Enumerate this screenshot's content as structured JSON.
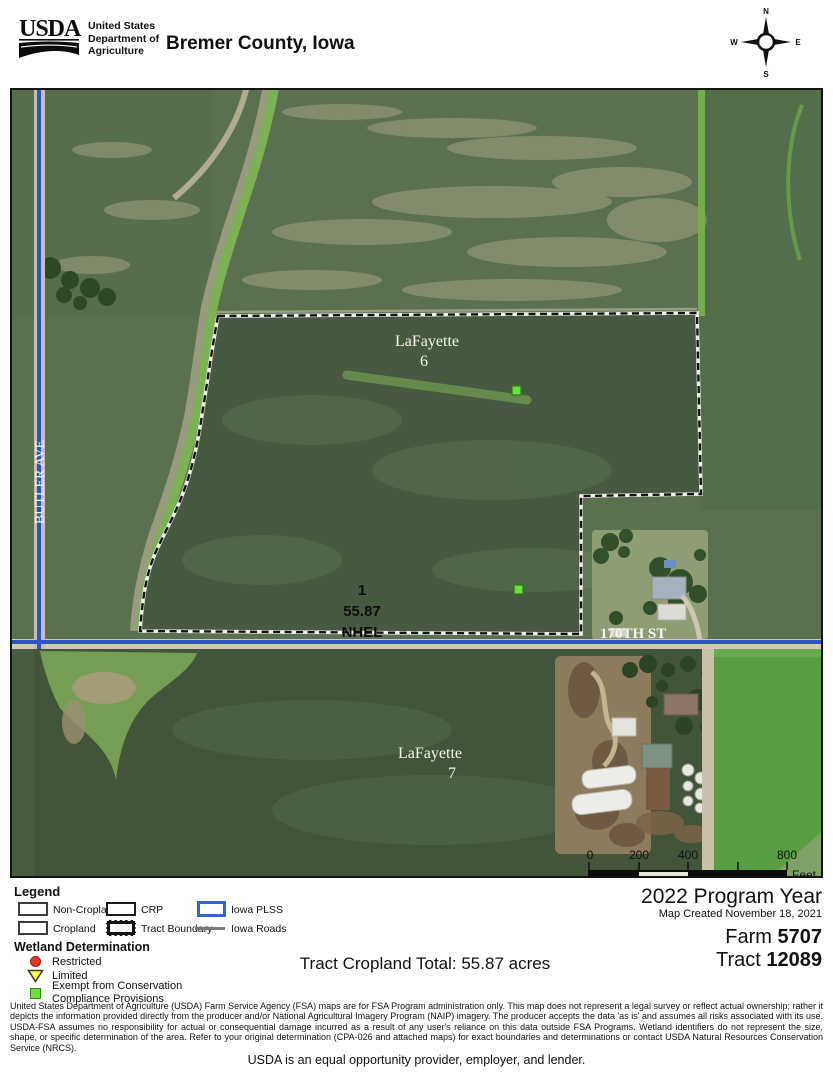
{
  "header": {
    "logo": "USDA",
    "agency_lines": [
      "United States",
      "Department of",
      "Agriculture"
    ],
    "title": "Bremer County, Iowa",
    "compass": {
      "n": "N",
      "e": "E",
      "s": "S",
      "w": "W"
    }
  },
  "map": {
    "sections": {
      "top": {
        "name": "LaFayette",
        "number": "6"
      },
      "bottom": {
        "name": "LaFayette",
        "number": "7"
      }
    },
    "tract_label": {
      "field_number": "1",
      "acres": "55.87",
      "hel": "NHEL"
    },
    "roads": {
      "vertical": "BUTLER AVE",
      "horizontal": "170TH ST"
    },
    "scale_bar": {
      "ticks": [
        "0",
        "200",
        "400",
        "800"
      ],
      "unit": "Feet"
    }
  },
  "legend": {
    "title": "Legend",
    "items": [
      {
        "label": "Non-Cropland",
        "swatch": "outline-gray-box"
      },
      {
        "label": "CRP",
        "swatch": "outline-dark-box"
      },
      {
        "label": "Iowa PLSS",
        "swatch": "outline-blue-box"
      },
      {
        "label": "Cropland",
        "swatch": "outline-dark-box"
      },
      {
        "label": "Tract Boundary",
        "swatch": "thick-dashed-box"
      },
      {
        "label": "Iowa Roads",
        "swatch": "gray-line"
      }
    ],
    "wetland": {
      "title": "Wetland Determination",
      "items": [
        {
          "label": "Restricted",
          "symbol": "red-circle",
          "color": "#e2372b"
        },
        {
          "label": "Limited",
          "symbol": "yellow-triangle",
          "color": "#ffff55"
        },
        {
          "label": "Exempt from Conservation Compliance Provisions",
          "symbol": "green-square",
          "color": "#6be03c"
        }
      ]
    }
  },
  "summary": {
    "cropland_total": "Tract Cropland Total:  55.87 acres"
  },
  "info": {
    "program_year": "2022 Program Year",
    "map_created": "Map Created November 18, 2021",
    "farm_label": "Farm",
    "farm_number": "5707",
    "tract_label": "Tract",
    "tract_number": "12089"
  },
  "footer": {
    "disclaimer": "United States Department of Agriculture (USDA) Farm Service Agency (FSA) maps are for FSA Program administration only.  This map does not represent a legal survey or reflect actual ownership; rather it depicts the information provided directly from the producer and/or National Agricultural Imagery Program (NAIP) imagery.  The producer accepts the data 'as is' and assumes all risks associated with its use.  USDA-FSA assumes no responsibility for actual or consequential damage incurred as a result of any user's reliance on this data outside FSA Programs.  Wetland identifiers do not represent the size, shape, or specific determination of the area.  Refer to your original determination (CPA-026 and attached maps) for exact boundaries and determinations or contact USDA Natural Resources Conservation Service (NRCS).",
    "eo_statement": "USDA is an equal opportunity provider, employer, and lender."
  },
  "colors": {
    "road_blue": "#2b54c6",
    "plss_blue": "#3566c2",
    "restricted_red": "#e2372b",
    "limited_yellow": "#ffff55",
    "exempt_green": "#6be03c",
    "boundary_black": "#141414"
  }
}
